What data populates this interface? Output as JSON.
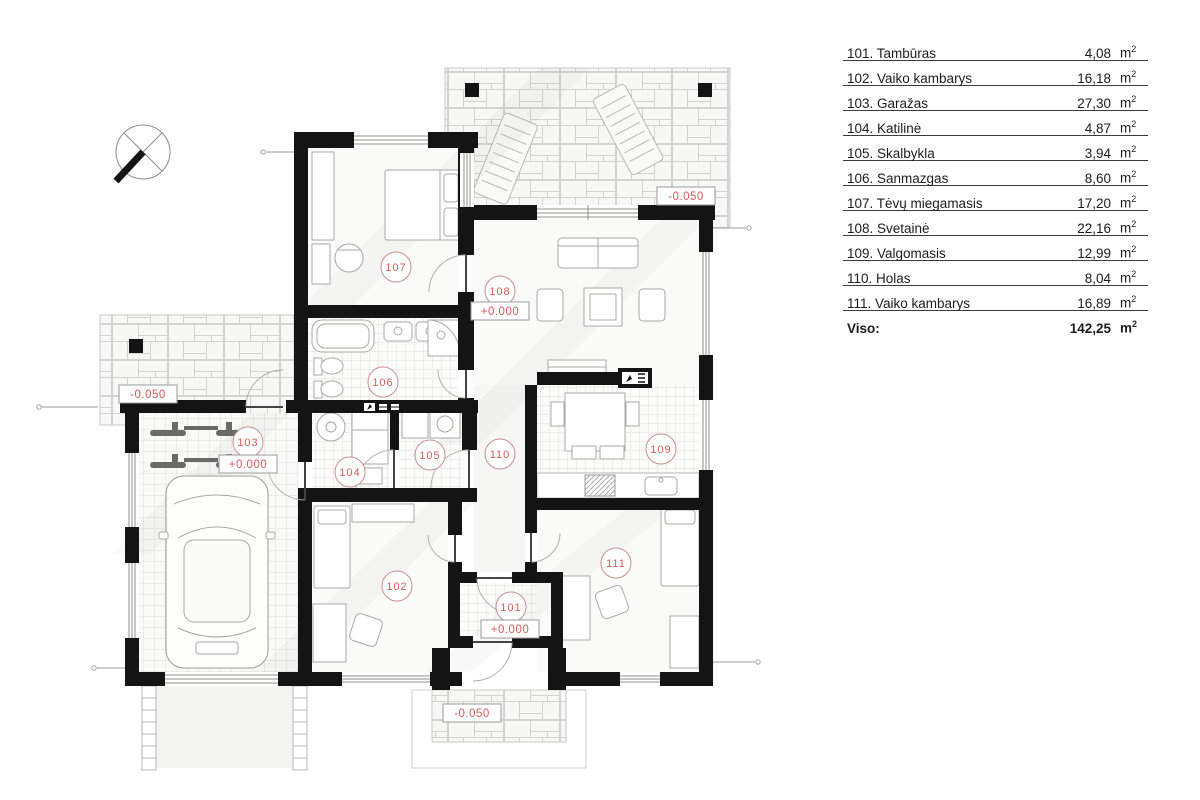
{
  "legend": {
    "rows": [
      {
        "label": "101. Tambūras",
        "value": "4,08",
        "unit": "m",
        "unit_sup": "2"
      },
      {
        "label": "102. Vaiko kambarys",
        "value": "16,18",
        "unit": "m",
        "unit_sup": "2"
      },
      {
        "label": "103. Garažas",
        "value": "27,30",
        "unit": "m",
        "unit_sup": "2"
      },
      {
        "label": "104. Katilinė",
        "value": "4,87",
        "unit": "m",
        "unit_sup": "2"
      },
      {
        "label": "105. Skalbykla",
        "value": "3,94",
        "unit": "m",
        "unit_sup": "2"
      },
      {
        "label": "106. Sanmazgas",
        "value": "8,60",
        "unit": "m",
        "unit_sup": "2"
      },
      {
        "label": "107. Tėvų miegamasis",
        "value": "17,20",
        "unit": "m",
        "unit_sup": "2"
      },
      {
        "label": "108. Svetainė",
        "value": "22,16",
        "unit": "m",
        "unit_sup": "2"
      },
      {
        "label": "109. Valgomasis",
        "value": "12,99",
        "unit": "m",
        "unit_sup": "2"
      },
      {
        "label": "110. Holas",
        "value": "8,04",
        "unit": "m",
        "unit_sup": "2"
      },
      {
        "label": "111. Vaiko kambarys",
        "value": "16,89",
        "unit": "m",
        "unit_sup": "2"
      }
    ],
    "total": {
      "label": "Viso:",
      "value": "142,25",
      "unit": "m",
      "unit_sup": "2"
    }
  },
  "plan": {
    "room_markers": [
      {
        "id": "101",
        "cx": 511,
        "cy": 607,
        "elev": "+0.000",
        "ex": 510,
        "ey": 629
      },
      {
        "id": "102",
        "cx": 397,
        "cy": 586
      },
      {
        "id": "103",
        "cx": 248,
        "cy": 442,
        "elev": "+0.000",
        "ex": 248,
        "ey": 464
      },
      {
        "id": "104",
        "cx": 350,
        "cy": 472
      },
      {
        "id": "105",
        "cx": 430,
        "cy": 455
      },
      {
        "id": "106",
        "cx": 383,
        "cy": 382
      },
      {
        "id": "107",
        "cx": 396,
        "cy": 267
      },
      {
        "id": "108",
        "cx": 500,
        "cy": 291,
        "elev": "+0.000",
        "ex": 500,
        "ey": 311
      },
      {
        "id": "109",
        "cx": 661,
        "cy": 449
      },
      {
        "id": "110",
        "cx": 500,
        "cy": 454
      },
      {
        "id": "111",
        "cx": 616,
        "cy": 563
      }
    ],
    "elevation_markers": [
      {
        "value": "-0.050",
        "x": 686,
        "y": 196
      },
      {
        "value": "-0.050",
        "x": 148,
        "y": 394
      },
      {
        "value": "-0.050",
        "x": 472,
        "y": 713
      }
    ],
    "colors": {
      "accent_red": "#d85a5a",
      "wall_black": "#141414",
      "circle_stroke": "#c89090"
    }
  }
}
